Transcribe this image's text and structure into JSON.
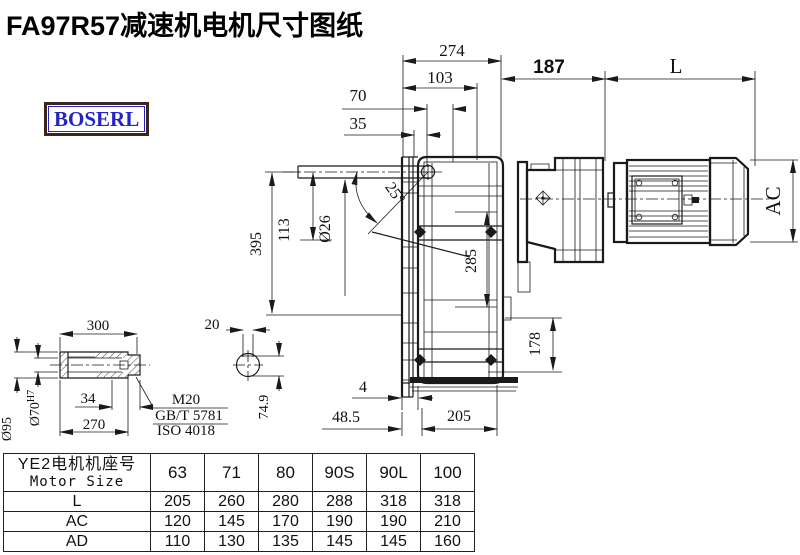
{
  "title": "FA97R57减速机电机尺寸图纸",
  "logo": {
    "text": "BOSERL",
    "text_color": "#2424c4",
    "border_color": "#3d241c"
  },
  "drawing": {
    "annotations": [
      {
        "id": "dim-274",
        "text": "274",
        "x": 452,
        "y": 56,
        "size": 17
      },
      {
        "id": "dim-103",
        "text": "103",
        "x": 440,
        "y": 83,
        "size": 17
      },
      {
        "id": "dim-70",
        "text": "70",
        "x": 358,
        "y": 101,
        "size": 17
      },
      {
        "id": "dim-35",
        "text": "35",
        "x": 358,
        "y": 129,
        "size": 17
      },
      {
        "id": "dim-187",
        "text": "187",
        "x": 549,
        "y": 73,
        "size": 19,
        "bold": true,
        "sans": true
      },
      {
        "id": "dim-L",
        "text": "L",
        "x": 676,
        "y": 73,
        "size": 21
      },
      {
        "id": "dim-AC",
        "text": "AC",
        "x": 780,
        "y": 201,
        "size": 21,
        "rot": -90
      },
      {
        "id": "dim-395",
        "text": "395",
        "x": 261,
        "y": 244,
        "size": 16,
        "rot": -90
      },
      {
        "id": "dim-113",
        "text": "113",
        "x": 289,
        "y": 230,
        "size": 16,
        "rot": -90
      },
      {
        "id": "dim-O26",
        "text": "Ø26",
        "x": 330,
        "y": 229,
        "size": 16,
        "rot": -90
      },
      {
        "id": "dim-25deg",
        "text": "25°",
        "x": 391,
        "y": 196,
        "size": 16,
        "rot": 55
      },
      {
        "id": "dim-285",
        "text": "285",
        "x": 476,
        "y": 261,
        "size": 16,
        "rot": -90
      },
      {
        "id": "dim-178",
        "text": "178",
        "x": 540,
        "y": 344,
        "size": 16,
        "rot": -90
      },
      {
        "id": "dim-4",
        "text": "4",
        "x": 363,
        "y": 392,
        "size": 16
      },
      {
        "id": "dim-48-5",
        "text": "48.5",
        "x": 346,
        "y": 422,
        "size": 16
      },
      {
        "id": "dim-205",
        "text": "205",
        "x": 459,
        "y": 421,
        "size": 16
      },
      {
        "id": "dim-300",
        "text": "300",
        "x": 98,
        "y": 330,
        "size": 15
      },
      {
        "id": "dim-20",
        "text": "20",
        "x": 212,
        "y": 329,
        "size": 15
      },
      {
        "id": "dim-34",
        "text": "34",
        "x": 88,
        "y": 403,
        "size": 15
      },
      {
        "id": "dim-270",
        "text": "270",
        "x": 94,
        "y": 429,
        "size": 15
      },
      {
        "id": "dim-O95",
        "text": "Ø95",
        "x": 11,
        "y": 429,
        "size": 14,
        "rot": -90
      },
      {
        "id": "dim-O70H7",
        "text": "Ø70",
        "sup": "H7",
        "x": 39,
        "y": 408,
        "size": 14,
        "rot": -90
      },
      {
        "id": "dim-74-9",
        "text": "74.9",
        "x": 268,
        "y": 407,
        "size": 14,
        "rot": -90
      },
      {
        "id": "note-m20",
        "text": "M20",
        "x": 186,
        "y": 404,
        "size": 15
      },
      {
        "id": "note-gb",
        "text": "GB/T 5781",
        "x": 189,
        "y": 420,
        "size": 15
      },
      {
        "id": "note-iso",
        "text": "ISO 4018",
        "x": 186,
        "y": 435,
        "size": 15
      }
    ]
  },
  "table": {
    "header": {
      "line1": "YE2电机机座号",
      "line2": "Motor Size"
    },
    "columns": [
      "63",
      "71",
      "80",
      "90S",
      "90L",
      "100"
    ],
    "rows": [
      {
        "label": "L",
        "values": [
          "205",
          "260",
          "280",
          "288",
          "318",
          "318"
        ]
      },
      {
        "label": "AC",
        "values": [
          "120",
          "145",
          "170",
          "190",
          "190",
          "210"
        ]
      },
      {
        "label": "AD",
        "values": [
          "110",
          "130",
          "135",
          "145",
          "145",
          "160"
        ]
      }
    ]
  },
  "colors": {
    "line": "#1a1a1a",
    "text": "#111111",
    "background": "#ffffff"
  }
}
